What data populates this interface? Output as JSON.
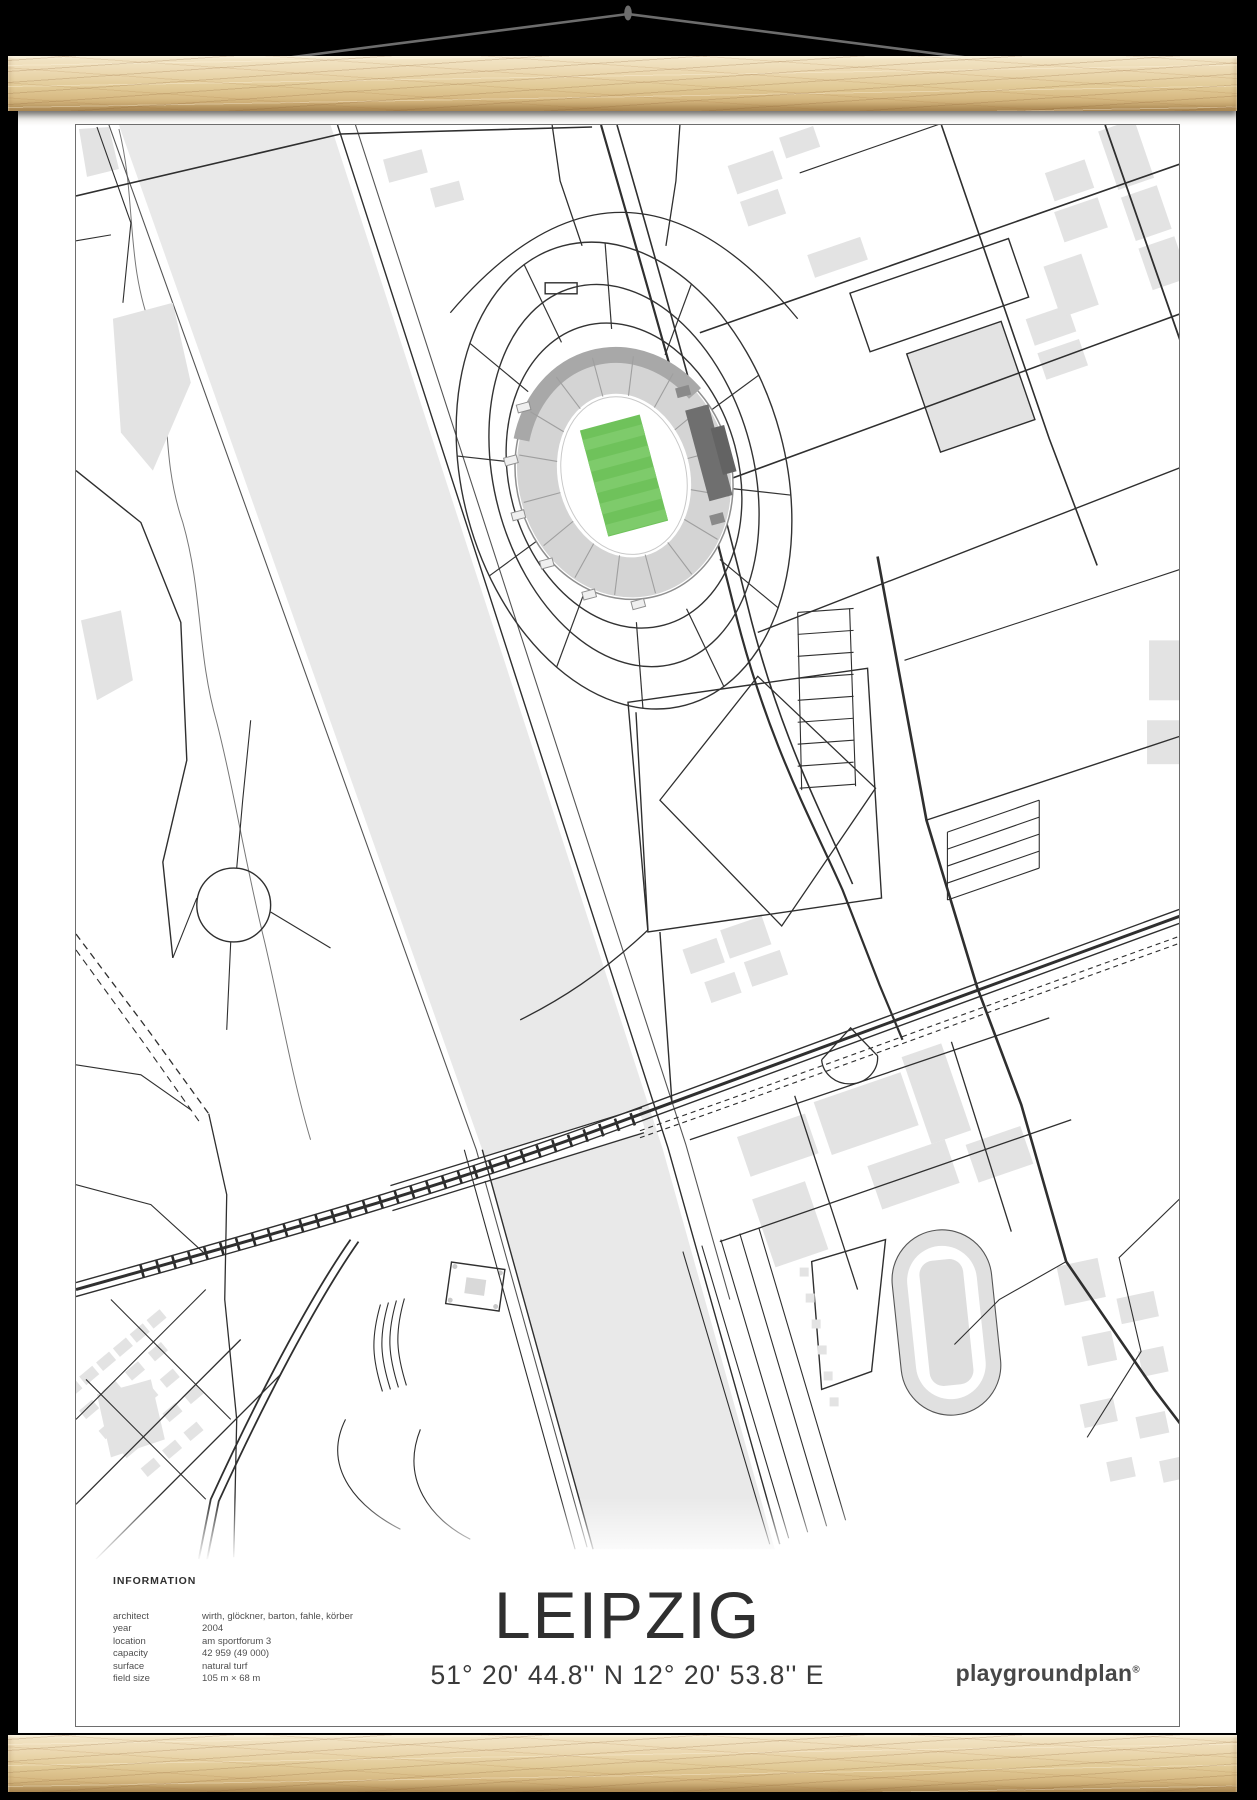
{
  "poster": {
    "title": "LEIPZIG",
    "coordinates": "51° 20' 44.8'' N  12° 20' 53.8'' E",
    "brand": "playgroundplan",
    "brand_mark": "®",
    "info": {
      "heading": "INFORMATION",
      "rows": [
        {
          "label": "architect",
          "value": "wirth, glöckner, barton, fahle, körber"
        },
        {
          "label": "year",
          "value": "2004"
        },
        {
          "label": "location",
          "value": "am sportforum 3"
        },
        {
          "label": "capacity",
          "value": "42 959 (49 000)"
        },
        {
          "label": "surface",
          "value": "natural turf"
        },
        {
          "label": "field size",
          "value": "105 m × 68 m"
        }
      ]
    }
  },
  "colors": {
    "background": "#000000",
    "poster": "#ffffff",
    "frame_border": "#6e6e6e",
    "map_line": "#2f2f2f",
    "building": "#e3e3e3",
    "water": "#e9e9e9",
    "stand_gray": "#d4d4d4",
    "stand_dark": "#a8a8a8",
    "block_dark": "#6f6f6f",
    "pitch_green": "#6fc25b",
    "pitch_stripe": "#7ecb6b",
    "string": "#6d6d6d",
    "text_dark": "#2f2f2f",
    "text_gray": "#4f4f4f"
  }
}
